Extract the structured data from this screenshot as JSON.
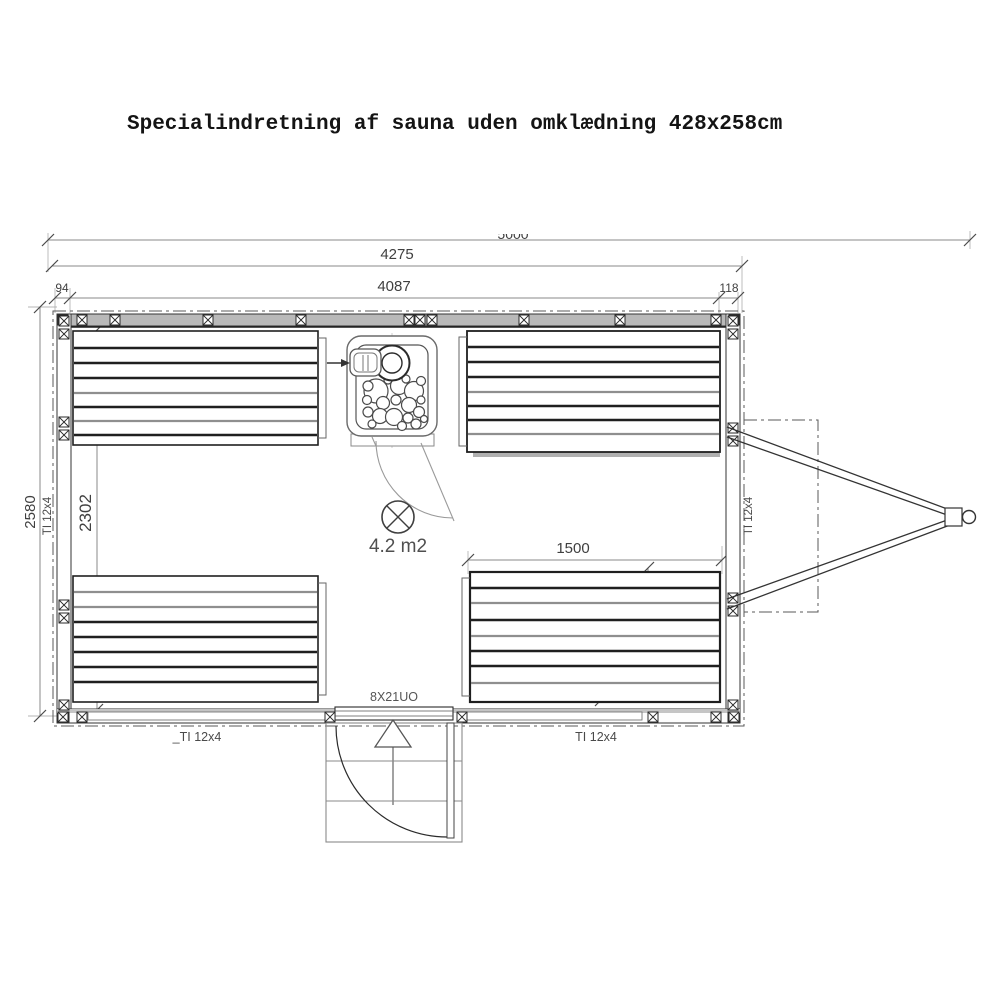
{
  "title": "Specialindretning af sauna uden omklædning 428x258cm",
  "dimensions": {
    "overall_length": "5000",
    "frame_length": "4275",
    "left_wall_offset": "94",
    "inner_length": "4087",
    "right_wall_offset": "118",
    "overall_width": "2580",
    "inner_width": "2302",
    "bench_length": "1500",
    "bench_backrest_depth": "300",
    "bench_seat_depth": "500"
  },
  "labels": {
    "floor_area": "4.2 m2",
    "door_spec": "8X21UO",
    "left_wall_timber": "TI 12x4",
    "right_wall_timber": "TI 12x4",
    "bottom_wall_timber_left": "_TI 12x4",
    "bottom_wall_timber_right": "TI 12x4"
  }
}
